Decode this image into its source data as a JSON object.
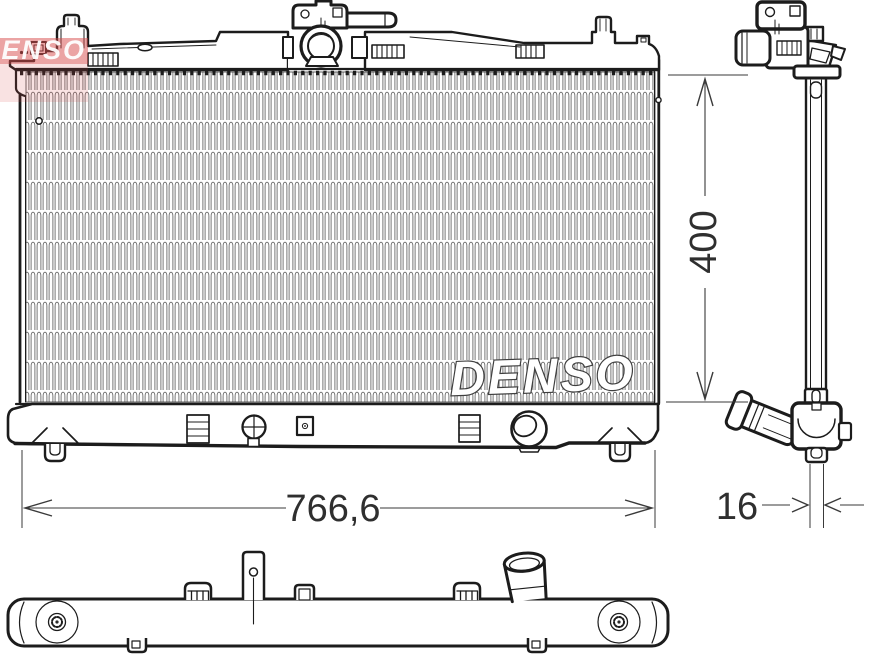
{
  "branding": {
    "logo_text": "DENSO",
    "logo_color": "#d84a4a",
    "watermark_text": "DENSO"
  },
  "dimensions": {
    "width_label": "766,6",
    "height_label": "400",
    "depth_label": "16"
  },
  "drawing": {
    "line_color": "#1c1c1c",
    "dim_text_color": "#2f2f2f",
    "fin_color": "#6a6a6a",
    "background": "#ffffff"
  }
}
